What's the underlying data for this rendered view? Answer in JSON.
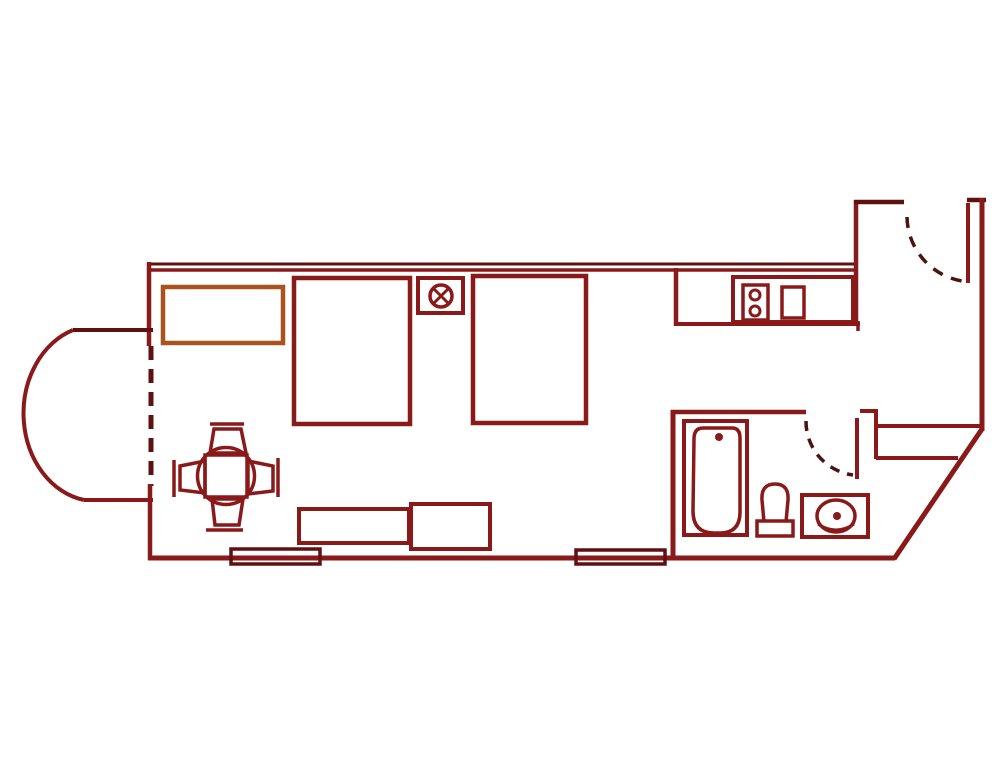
{
  "canvas": {
    "width": 1000,
    "height": 781,
    "background": "#ffffff"
  },
  "palette": {
    "wall": "#8a1a1a",
    "wallDark": "#5f1111",
    "ink": "#4c1410",
    "accent": "#a9541f",
    "bg": "#ffffff"
  },
  "defaults": {
    "width": 4,
    "fill": "none",
    "stroke": "wall"
  },
  "elements": [
    {
      "name": "top-wall-outer",
      "kind": "line",
      "x1": 148,
      "y1": 264,
      "x2": 857,
      "y2": 264,
      "stroke": "wallDark",
      "width": 3
    },
    {
      "name": "top-wall-inner",
      "kind": "line",
      "x1": 148,
      "y1": 270,
      "x2": 857,
      "y2": 270,
      "stroke": "wall",
      "width": 3.5
    },
    {
      "name": "left-wall-upper",
      "kind": "line",
      "x1": 149,
      "y1": 262,
      "x2": 149,
      "y2": 346,
      "stroke": "wall",
      "width": 4.5
    },
    {
      "name": "bay-opening-window",
      "kind": "line",
      "x1": 151,
      "y1": 346,
      "x2": 151,
      "y2": 486,
      "stroke": "wallDark",
      "width": 5,
      "dash": "14 9"
    },
    {
      "name": "left-wall-lower",
      "kind": "line",
      "x1": 150,
      "y1": 484,
      "x2": 150,
      "y2": 560,
      "stroke": "wall",
      "width": 4.5
    },
    {
      "name": "bottom-wall",
      "kind": "line",
      "x1": 148,
      "y1": 558,
      "x2": 895,
      "y2": 558,
      "stroke": "wall",
      "width": 5
    },
    {
      "name": "bay-top-wall",
      "kind": "line",
      "x1": 73,
      "y1": 330,
      "x2": 153,
      "y2": 330,
      "stroke": "wallDark",
      "width": 4
    },
    {
      "name": "bay-bottom-wall",
      "kind": "line",
      "x1": 84,
      "y1": 500,
      "x2": 153,
      "y2": 500,
      "stroke": "wall",
      "width": 4
    },
    {
      "name": "bay-curved-wall",
      "kind": "path",
      "d": "M 73 330 A 73 88 0 0 0 84 500",
      "stroke": "wall",
      "width": 4
    },
    {
      "name": "entry-left-wall",
      "kind": "line",
      "x1": 856,
      "y1": 200,
      "x2": 856,
      "y2": 326,
      "stroke": "wall",
      "width": 4.5
    },
    {
      "name": "entry-top-wall",
      "kind": "line",
      "x1": 854,
      "y1": 202,
      "x2": 904,
      "y2": 202,
      "stroke": "wallDark",
      "width": 4.5
    },
    {
      "name": "entry-top-right-wall",
      "kind": "line",
      "x1": 967,
      "y1": 200,
      "x2": 986,
      "y2": 200,
      "stroke": "wallDark",
      "width": 4.5
    },
    {
      "name": "right-wall",
      "kind": "line",
      "x1": 982,
      "y1": 198,
      "x2": 982,
      "y2": 431,
      "stroke": "wall",
      "width": 5
    },
    {
      "name": "diagonal-wall",
      "kind": "line",
      "x1": 982,
      "y1": 429,
      "x2": 894,
      "y2": 559,
      "stroke": "wall",
      "width": 5
    },
    {
      "name": "bathroom-left-wall",
      "kind": "line",
      "x1": 673,
      "y1": 410,
      "x2": 673,
      "y2": 560,
      "stroke": "wall",
      "width": 5
    },
    {
      "name": "bathroom-top-wall",
      "kind": "line",
      "x1": 671,
      "y1": 412,
      "x2": 806,
      "y2": 412,
      "stroke": "wall",
      "width": 4.5
    },
    {
      "name": "partition-step-top",
      "kind": "line",
      "x1": 860,
      "y1": 411,
      "x2": 877,
      "y2": 411,
      "stroke": "wall",
      "width": 4
    },
    {
      "name": "partition-left",
      "kind": "line",
      "x1": 876,
      "y1": 409,
      "x2": 876,
      "y2": 459,
      "stroke": "wall",
      "width": 4
    },
    {
      "name": "closet-top",
      "kind": "line",
      "x1": 876,
      "y1": 426,
      "x2": 980,
      "y2": 426,
      "stroke": "wall",
      "width": 4
    },
    {
      "name": "closet-bottom",
      "kind": "line",
      "x1": 876,
      "y1": 458,
      "x2": 958,
      "y2": 458,
      "stroke": "wall",
      "width": 4
    },
    {
      "name": "kitchen-side-wall",
      "kind": "line",
      "x1": 676,
      "y1": 268,
      "x2": 676,
      "y2": 326,
      "stroke": "wall",
      "width": 4.5
    },
    {
      "name": "kitchen-front-edge",
      "kind": "line",
      "x1": 676,
      "y1": 324,
      "x2": 860,
      "y2": 324,
      "stroke": "wall",
      "width": 4
    },
    {
      "name": "kitchen-front-cap",
      "kind": "line",
      "x1": 858,
      "y1": 321,
      "x2": 858,
      "y2": 331,
      "stroke": "wall",
      "width": 3.5
    },
    {
      "name": "bathroom-door-leaf",
      "kind": "line",
      "x1": 857,
      "y1": 418,
      "x2": 857,
      "y2": 479,
      "stroke": "wall",
      "width": 4
    },
    {
      "name": "bathroom-door-swing",
      "kind": "path",
      "d": "M 806 421 A 54 54 0 0 0 853 475",
      "stroke": "ink",
      "width": 3.5,
      "dash": "10 8"
    },
    {
      "name": "entry-door-leaf",
      "kind": "line",
      "x1": 968,
      "y1": 203,
      "x2": 968,
      "y2": 283,
      "stroke": "wall",
      "width": 4
    },
    {
      "name": "entry-door-swing",
      "kind": "path",
      "d": "M 907 217 A 66 66 0 0 0 962 281",
      "stroke": "ink",
      "width": 3.5,
      "dash": "11 9"
    },
    {
      "name": "storage-cabinet",
      "kind": "rect",
      "x": 163,
      "y": 287,
      "w": 120,
      "h": 56,
      "stroke": "accent",
      "width": 4.5
    },
    {
      "name": "bed-1",
      "kind": "rect",
      "x": 294,
      "y": 278,
      "w": 116,
      "h": 146,
      "stroke": "wall",
      "width": 4.5
    },
    {
      "name": "bed-2",
      "kind": "rect",
      "x": 473,
      "y": 276,
      "w": 113,
      "h": 147,
      "stroke": "wall",
      "width": 4.5
    },
    {
      "name": "light-fixture-box",
      "kind": "rect",
      "x": 418,
      "y": 278,
      "w": 45,
      "h": 35,
      "stroke": "wall",
      "width": 4
    },
    {
      "name": "light-fixture-circle",
      "kind": "circle",
      "cx": 441,
      "cy": 296,
      "r": 11,
      "stroke": "wall",
      "width": 3.5
    },
    {
      "name": "light-fixture-x1",
      "kind": "line",
      "x1": 434,
      "y1": 289,
      "x2": 448,
      "y2": 303,
      "stroke": "wall",
      "width": 3
    },
    {
      "name": "light-fixture-x2",
      "kind": "line",
      "x1": 448,
      "y1": 289,
      "x2": 434,
      "y2": 303,
      "stroke": "wall",
      "width": 3
    },
    {
      "name": "kitchen-counter",
      "kind": "rect",
      "x": 733,
      "y": 277,
      "w": 120,
      "h": 45,
      "stroke": "wall",
      "width": 4
    },
    {
      "name": "stove",
      "kind": "rect",
      "x": 743,
      "y": 285,
      "w": 25,
      "h": 35,
      "stroke": "wall",
      "width": 3.5
    },
    {
      "name": "stove-burner-top",
      "kind": "circle",
      "cx": 755,
      "cy": 295,
      "r": 5,
      "stroke": "wall",
      "width": 3
    },
    {
      "name": "stove-burner-bottom",
      "kind": "circle",
      "cx": 755,
      "cy": 311,
      "r": 5,
      "stroke": "wall",
      "width": 3
    },
    {
      "name": "kitchen-sink",
      "kind": "rect",
      "x": 782,
      "y": 287,
      "w": 22,
      "h": 31,
      "stroke": "wall",
      "width": 3.5
    },
    {
      "name": "bathtub",
      "kind": "rect",
      "x": 684,
      "y": 421,
      "w": 63,
      "h": 114,
      "stroke": "wall",
      "width": 4
    },
    {
      "name": "bathtub-basin",
      "kind": "path",
      "d": "M 703 428 L 732 428 Q 740 428 740 438 L 740 512 Q 740 533 720 533 L 714 533 Q 693 533 693 511 L 694 439 Q 694 428 703 428 Z",
      "stroke": "wall",
      "width": 3.5
    },
    {
      "name": "bathtub-drain",
      "kind": "circle",
      "cx": 719,
      "cy": 437,
      "r": 4,
      "stroke": "none",
      "fill": "wall",
      "width": 0
    },
    {
      "name": "toilet-bowl",
      "kind": "path",
      "d": "M 764 522 L 762 500 Q 761 484 775 484 Q 789 484 788 500 L 786 522",
      "stroke": "wall",
      "width": 3.5
    },
    {
      "name": "toilet-base",
      "kind": "rect",
      "x": 757,
      "y": 521,
      "w": 36,
      "h": 15,
      "stroke": "wall",
      "width": 3.5
    },
    {
      "name": "vanity",
      "kind": "rect",
      "x": 802,
      "y": 495,
      "w": 66,
      "h": 42,
      "stroke": "wall",
      "width": 4
    },
    {
      "name": "vanity-basin",
      "kind": "ellipse",
      "cx": 836,
      "cy": 516,
      "rx": 19,
      "ry": 16,
      "stroke": "wall",
      "width": 3.5
    },
    {
      "name": "vanity-basin-lip",
      "kind": "path",
      "d": "M 818 524 Q 836 536 854 524",
      "stroke": "wall",
      "width": 3
    },
    {
      "name": "vanity-drain",
      "kind": "circle",
      "cx": 837,
      "cy": 516,
      "r": 4,
      "stroke": "none",
      "fill": "wall",
      "width": 0
    },
    {
      "name": "dining-table",
      "kind": "circle",
      "cx": 226,
      "cy": 476,
      "r": 28.5,
      "stroke": "wall",
      "width": 3.5
    },
    {
      "name": "dining-table-mat",
      "kind": "rect",
      "x": 205,
      "y": 455,
      "w": 42,
      "h": 42,
      "stroke": "wall",
      "width": 3.5
    },
    {
      "name": "chair-north-back",
      "kind": "line",
      "x1": 210,
      "y1": 424,
      "x2": 244,
      "y2": 424,
      "stroke": "wall",
      "width": 3.5
    },
    {
      "name": "chair-north",
      "kind": "polygon",
      "points": "214,429 241,429 246,453 210,453",
      "stroke": "wall",
      "width": 3.5
    },
    {
      "name": "chair-south",
      "kind": "polygon",
      "points": "212,499 243,499 239,525 215,525",
      "stroke": "wall",
      "width": 3.5
    },
    {
      "name": "chair-south-back",
      "kind": "line",
      "x1": 206,
      "y1": 530,
      "x2": 243,
      "y2": 530,
      "stroke": "wall",
      "width": 3.5
    },
    {
      "name": "chair-west-back",
      "kind": "line",
      "x1": 174,
      "y1": 460,
      "x2": 174,
      "y2": 497,
      "stroke": "wall",
      "width": 3.5
    },
    {
      "name": "chair-west",
      "kind": "polygon",
      "points": "180,466 205,461 205,493 180,490",
      "stroke": "wall",
      "width": 3.5
    },
    {
      "name": "chair-east-back",
      "kind": "line",
      "x1": 278,
      "y1": 458,
      "x2": 278,
      "y2": 497,
      "stroke": "wall",
      "width": 3.5
    },
    {
      "name": "chair-east",
      "kind": "polygon",
      "points": "248,461 273,466 273,491 248,494",
      "stroke": "wall",
      "width": 3.5
    },
    {
      "name": "bench-long",
      "kind": "rect",
      "x": 299,
      "y": 509,
      "w": 110,
      "h": 34,
      "stroke": "wall",
      "width": 4
    },
    {
      "name": "bench-short",
      "kind": "rect",
      "x": 411,
      "y": 504,
      "w": 79,
      "h": 45,
      "stroke": "wall",
      "width": 4
    },
    {
      "name": "window-sill-left",
      "kind": "rect",
      "x": 231,
      "y": 549,
      "w": 89,
      "h": 15,
      "stroke": "wallDark",
      "width": 3.5
    },
    {
      "name": "window-sill-mid",
      "kind": "rect",
      "x": 576,
      "y": 550,
      "w": 89,
      "h": 14,
      "stroke": "wallDark",
      "width": 3.5
    }
  ]
}
